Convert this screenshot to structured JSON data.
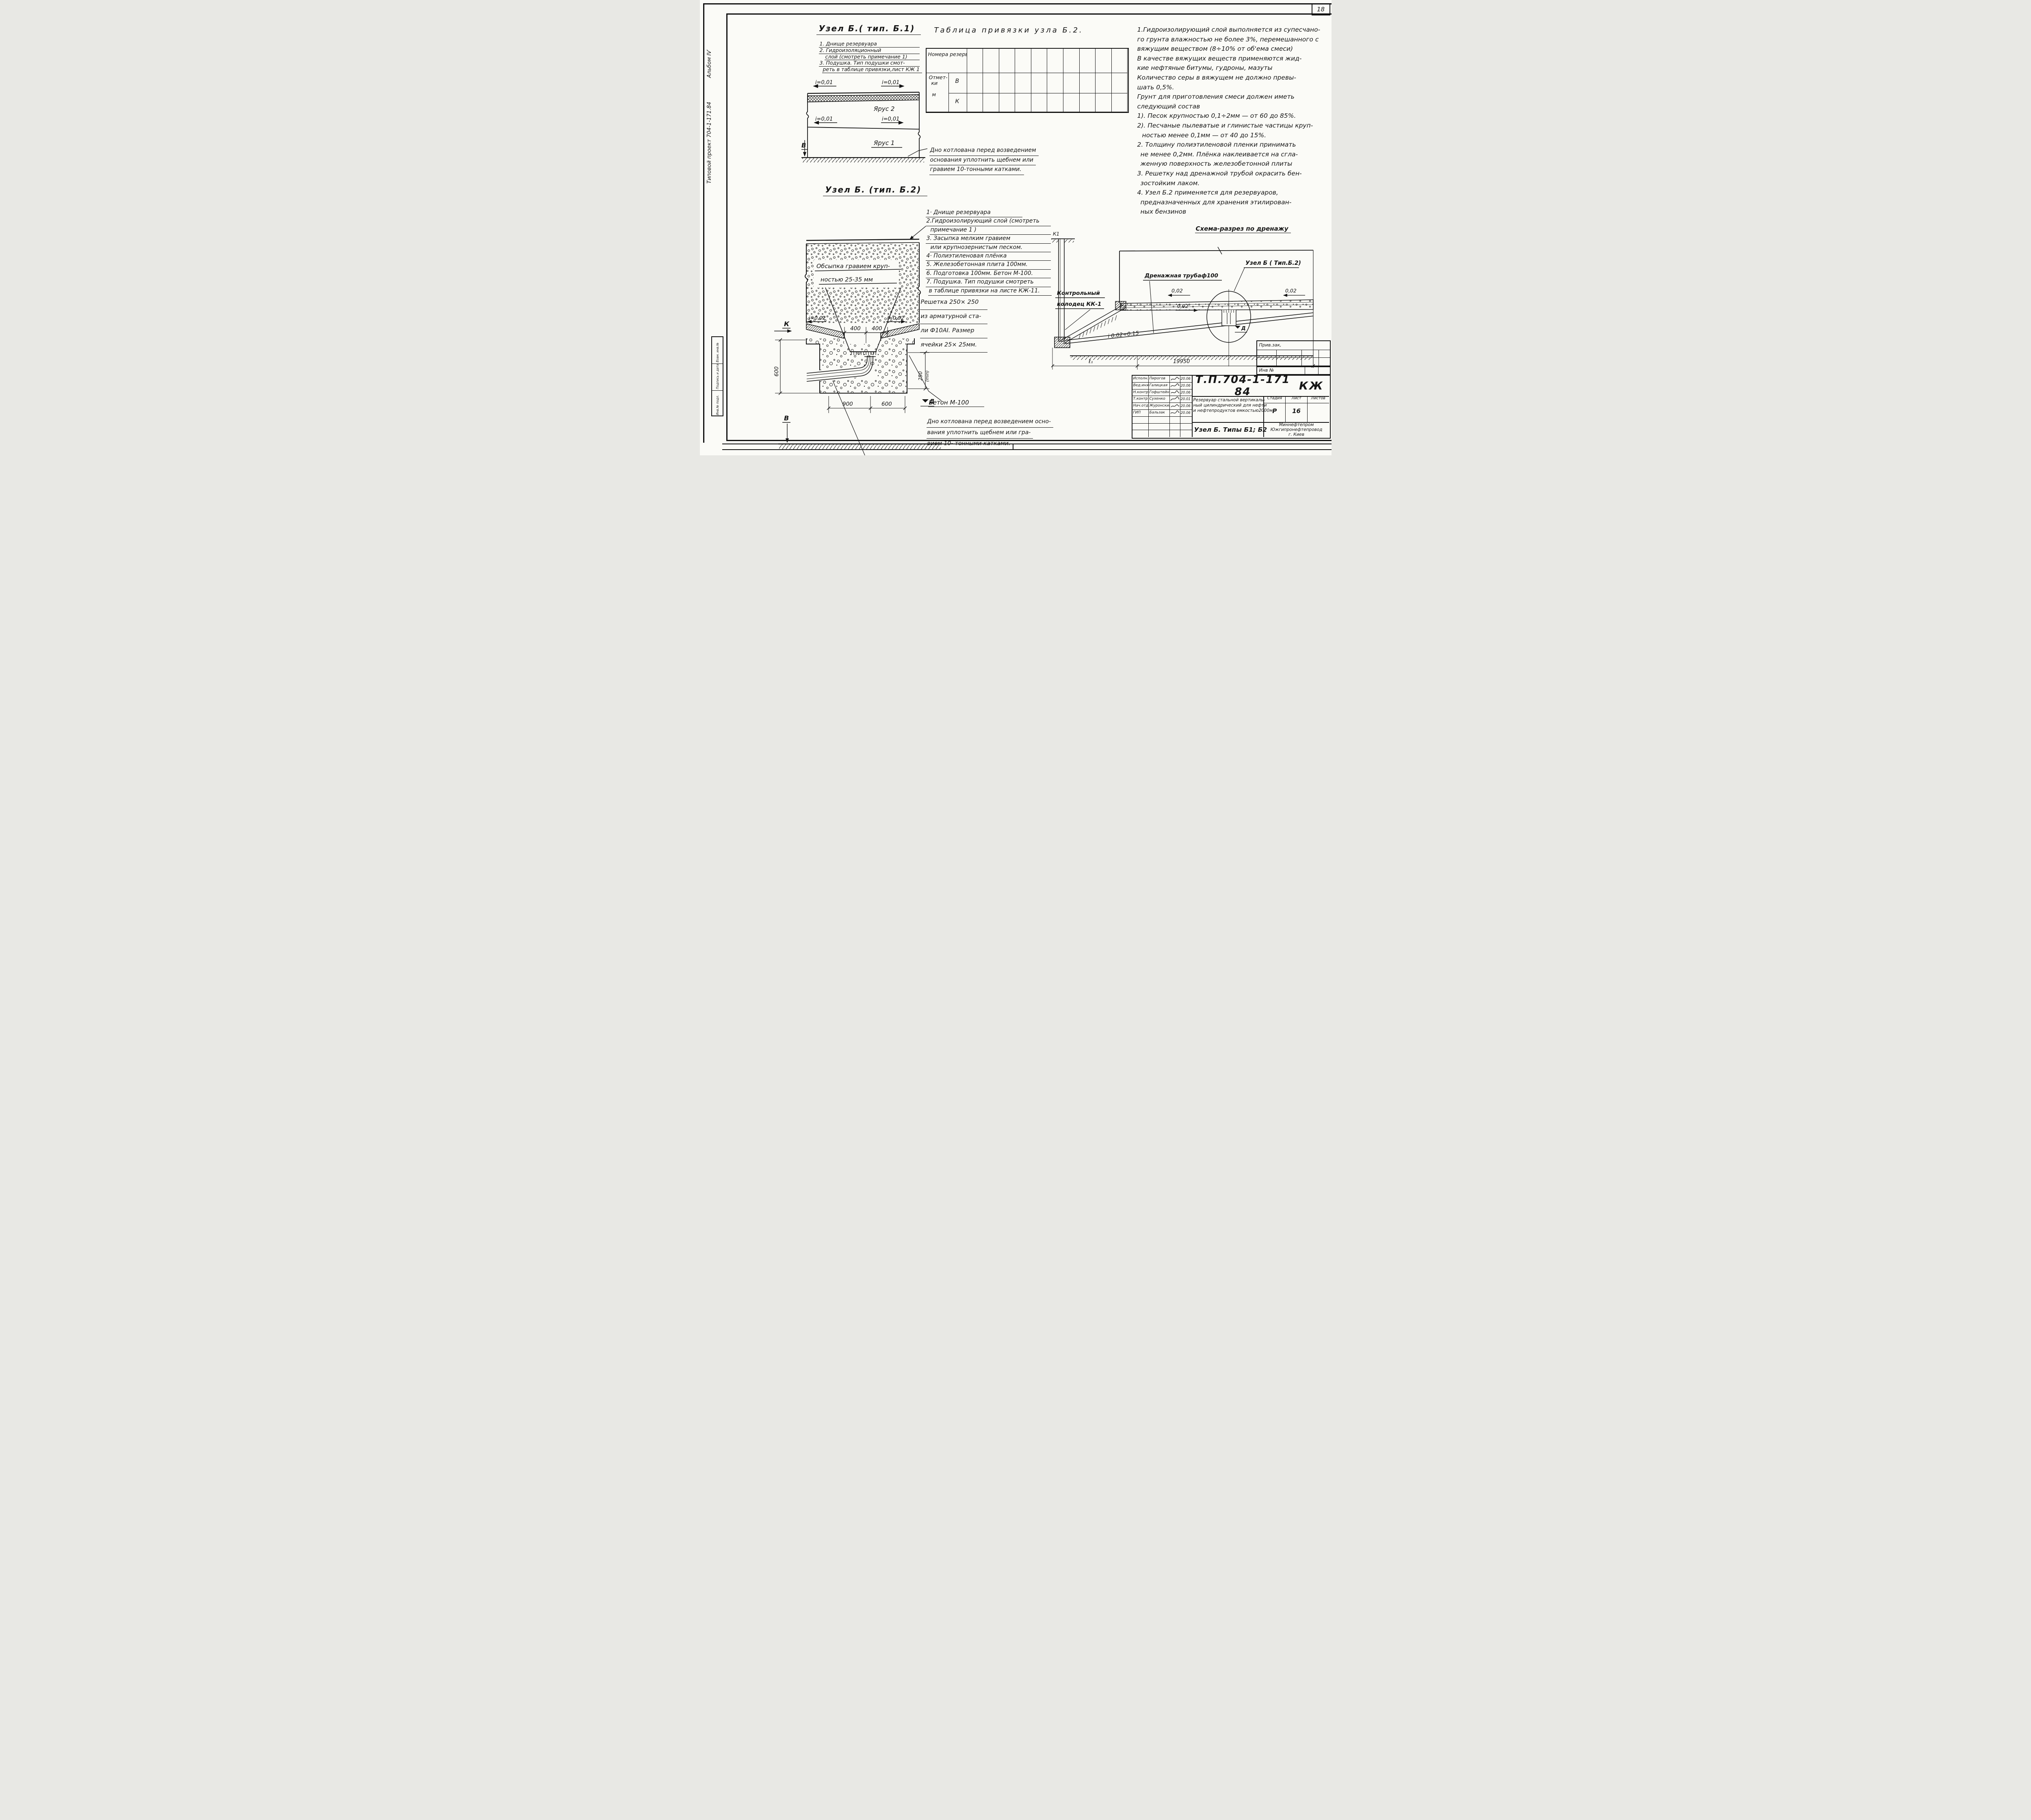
{
  "sheet": {
    "page_number": "18"
  },
  "margin": {
    "vertical_title": "Типовой проект 704-1-171.84",
    "album": "Альбом ІѴ",
    "stamp_top": "Взам. инв.№",
    "stamp_mid": "Подпись и дата",
    "stamp_bot": "Инв.№ подл."
  },
  "b1": {
    "title": "Узел Б.( тип. Б.1)",
    "notes": [
      "1. Днище резервуара",
      "2. Гидроизоляционный",
      "слой (смотреть примечание 1)",
      "3. Подушка. Тип подушки смот-",
      "реть в таблице привязки,лист КЖ 1"
    ],
    "slope_tl": "i=0,01",
    "slope_tr": "i=0,01",
    "slope_ml": "i=0,01",
    "slope_mr": "i=0,01",
    "tier2": "Ярус 2",
    "tier1": "Ярус 1",
    "marker_b": "В",
    "note": [
      "Дно котлована перед возведением",
      "основания уплотнить щебнем или",
      "гравием 10-тонными катками."
    ]
  },
  "table": {
    "title": "Таблица привязки узла Б.2.",
    "col_label": "Номера резервуаров",
    "row_label": "Отмет-",
    "row_label2": "ки",
    "row_unit": "м",
    "sub_b": "В",
    "sub_k": "К",
    "columns": 10
  },
  "notes_right": {
    "lines": [
      "1.Гидроизолирующий слой выполняется из супесчано-",
      "го грунта влажностью не более 3%, перемешанного с",
      "вяжущим веществом (8÷10% от об'ема смеси)",
      "В качестве вяжущих веществ применяются жид-",
      "кие нефтяные битумы, гудроны, мазуты",
      "Количество серы в вяжущем не должно превы-",
      "шать 0,5%.",
      "Грунт для приготовления смеси должен иметь",
      "следующий состав",
      "1). Песок крупностью 0,1÷2мм — от 60 до 85%.",
      "2). Песчаные пылеватые и глинистые частицы круп-",
      "ностью менее 0,1мм — от 40 до 15%.",
      "2. Толщину полиэтиленовой пленки принимать",
      "не менее 0,2мм. Плёнка наклеивается на сгла-",
      "женную поверхность железобетонной плиты",
      "3. Решетку над дренажной трубой окрасить бен-",
      "зостойким лаком.",
      "4. Узел Б.2 применяется для резервуаров,",
      "предназначенных для хранения этилирован-",
      "ных бензинов"
    ]
  },
  "b2": {
    "title": "Узел Б. (тип. Б.2)",
    "list": [
      "1· Днище резервуара",
      "2.Гидроизолирующий слой (смотреть",
      "примечание 1 )",
      "3. Засыпка мелким гравием",
      "или крупнозернистым песком.",
      "4· Полиэтиленовая плёнка",
      "5. Железобетонная плита 100мм.",
      "6. Подготовка 100мм. Бетон М-100.",
      "7. Подушка. Тип подушки смотреть",
      "в таблице привязки на листе КЖ-11."
    ],
    "gravel_label1": "Обсыпка гравием круп-",
    "gravel_label2": "ностью 25-35 мм",
    "dim_400a": "400",
    "dim_400b": "400",
    "slope_l": "i=0,02",
    "slope_r": "i=0,02",
    "dim_600v": "600",
    "dim_250": "250",
    "dim_250b": "(min)",
    "marker_k": "К",
    "marker_v": "В",
    "marker_d": "Д",
    "dim_900": "900",
    "dim_600h": "600",
    "drain_label": "Дренажная труба",
    "grate_label": [
      "Решетка 250× 250",
      "из арматурной ста-",
      "ли Ф10АІ. Размер",
      "ячейки 25× 25мм."
    ],
    "concrete_label": "Бетон М-100",
    "note": [
      "Дно котлована перед возведением осно-",
      "вания уплотнить щебнем или гра-",
      "вием 10- тонными катками."
    ]
  },
  "schema": {
    "title": "Схема-разрез по дренажу",
    "well_label1": "Контрольный",
    "well_label2": "колодец КК-1",
    "well_tag": "К1",
    "pipe_label": "Дренажная трубаф100",
    "node_label": "Узел Б ( Тип.Б.2)",
    "slope1": "0,02",
    "slope2": "0,02",
    "slope3": "0,02",
    "pipe_slope": "i 0.02÷0.15",
    "dim_e1": "ℓ₁",
    "dim_total": "19950",
    "marker_d": "Д"
  },
  "titleblock": {
    "doc_number": "Т.П.704-1-171 84",
    "doc_code": "КЖ",
    "rows": [
      {
        "role": "Исполн.",
        "name": "Пирогов",
        "date": "20.06"
      },
      {
        "role": "Вед.инж",
        "name": "Галицкая",
        "date": "20.06"
      },
      {
        "role": "Н.контр",
        "name": "Гофштейн",
        "date": "20.06"
      },
      {
        "role": "Т.контр",
        "name": "Сухенко",
        "date": "20.01"
      },
      {
        "role": "Нач.отд",
        "name": "Журонский",
        "date": "20.06"
      },
      {
        "role": "ГИП",
        "name": "Бальзак",
        "date": "20.06"
      }
    ],
    "project": [
      "Резервуар стальной вертикаль-",
      "ный цилиндрический для нефти",
      "и нефтепродуктов емкостью2000м³"
    ],
    "sheet_name": "Узел Б. Типы Б1; Б2",
    "stage_h": "Стадия",
    "list_h": "Лист",
    "listov_h": "Листов",
    "stage": "Р",
    "list": "16",
    "org": [
      "Миннефтепром",
      "Южгипронефтепровод",
      "г. Киев"
    ],
    "approve": "Прив.зак,",
    "inv": "Инв №"
  }
}
